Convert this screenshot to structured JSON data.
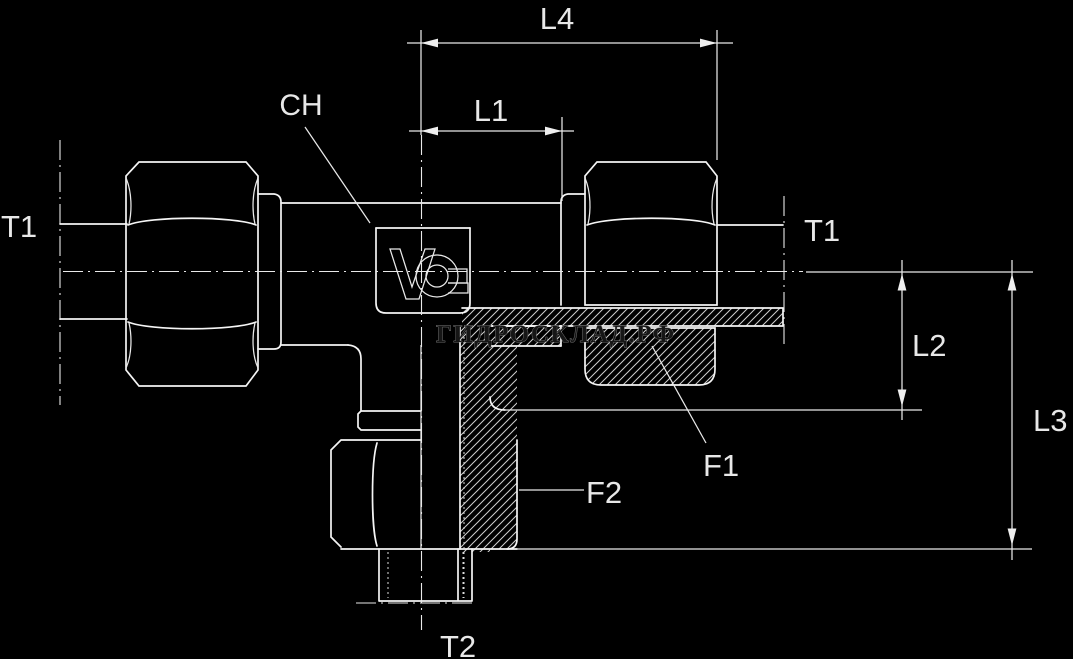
{
  "canvas": {
    "width": 1073,
    "height": 659,
    "background": "#000000"
  },
  "drawing": {
    "kind": "technical-drawing",
    "subject": "hydraulic tee fitting, half-section view with dimension callouts",
    "watermark": "ГИДРОСКЛАД.РФ",
    "logo": "voss-emblem",
    "labels": {
      "l4": "L4",
      "l1": "L1",
      "ch": "CH",
      "t1_left": "T1",
      "t1_right": "T1",
      "l2": "L2",
      "l3": "L3",
      "f1": "F1",
      "f2": "F2",
      "t2": "T2"
    },
    "colors": {
      "background": "#000000",
      "object_line": "#f5f5f5",
      "thin_line": "#e9e9e9",
      "hatch_line": "#cfcfcf",
      "label_text": "#e8e8e8",
      "watermark_fill": "#161616",
      "watermark_stroke": "#8a8a8a"
    }
  }
}
